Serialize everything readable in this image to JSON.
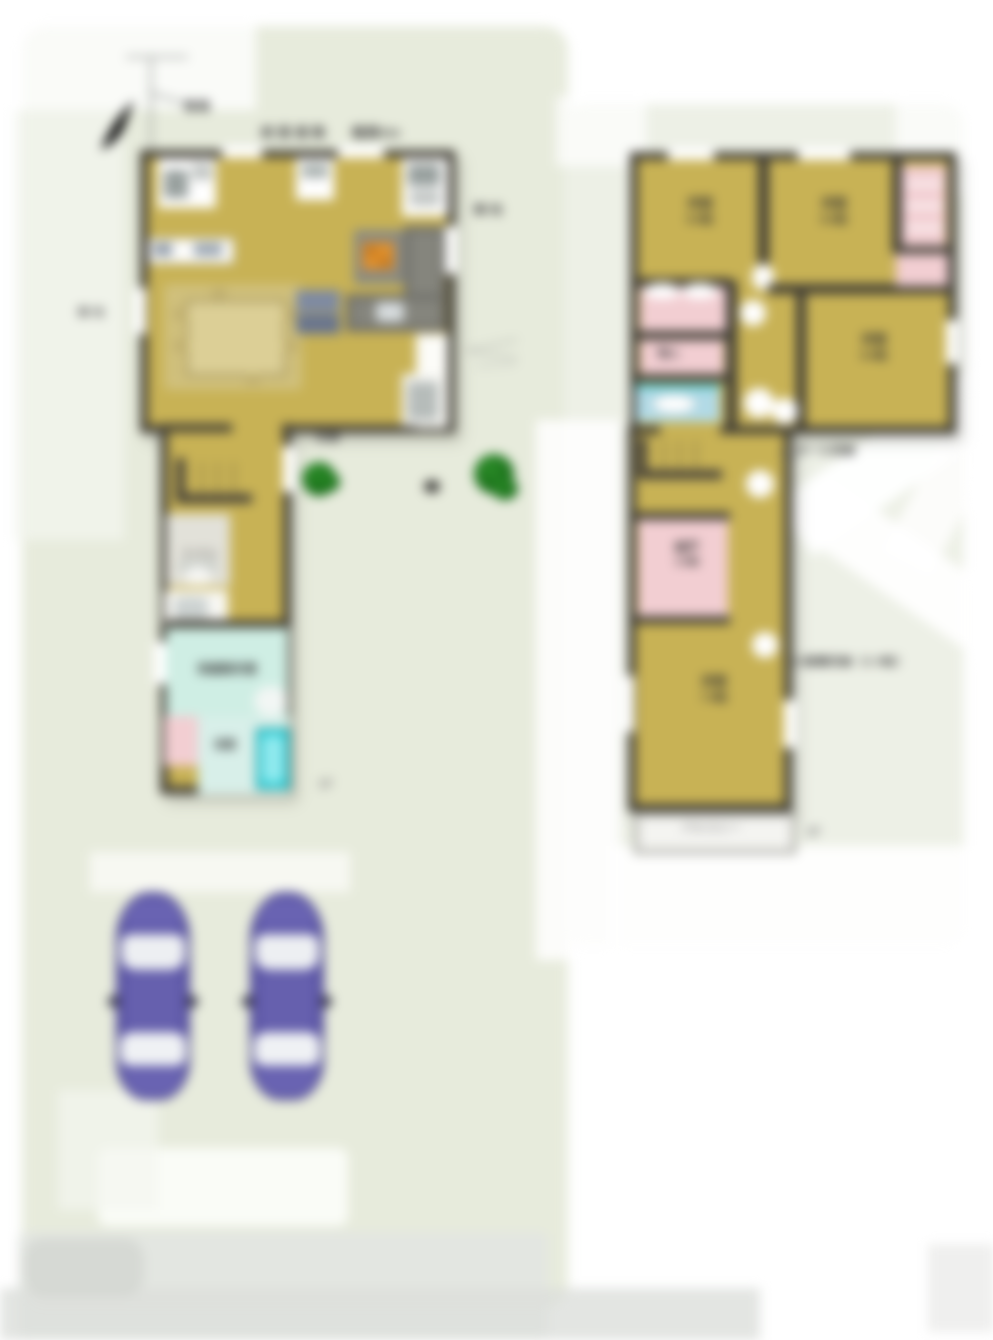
{
  "colors": {
    "floor_tan": "#c8b255",
    "wall_dark": "#413e35",
    "closet_pink": "#f2ced2",
    "washroom_mint": "#cfeee4",
    "bathtub_cyan": "#38d6de",
    "washbasin_blue": "#b2dae6",
    "car_purple": "#5a54a5",
    "tree_green": "#157015",
    "ground_green": "#e7ebdc"
  },
  "icons": {
    "north_arrow": "north-arrow",
    "tree": "tree",
    "car": "car-top-view",
    "toilet": "toilet",
    "bathtub": "bathtub",
    "sink": "sink",
    "stove": "gas-stove",
    "stairs": "stairs",
    "dining_table": "dining-table"
  },
  "annotations": {
    "road": "道路",
    "front_road": "前面道路",
    "road_width": "幅員6m",
    "neighbor_left": "隣地",
    "neighbor_right": "隣地",
    "entrance": "玄関"
  },
  "floor1": {
    "label": "1F",
    "toilet": "トイレ",
    "washroom": "洗面脱衣室",
    "bath": "浴室"
  },
  "floor2": {
    "label": "2F",
    "bedroom1": {
      "name": "洋室",
      "size": "6.0帖"
    },
    "bedroom2": {
      "name": "洋室",
      "size": "6.0帖"
    },
    "bedroom3": {
      "name": "洋室",
      "size": "6.0帖"
    },
    "bedroom4": {
      "name": "洋室",
      "size": "7.5帖"
    },
    "storage": {
      "name": "納戸",
      "size": "3.0帖"
    },
    "closet": "物入",
    "balcony": "バルコニー",
    "hall_note": "ホール収納",
    "attic_note": "小屋裏収納（2.5帖）"
  }
}
